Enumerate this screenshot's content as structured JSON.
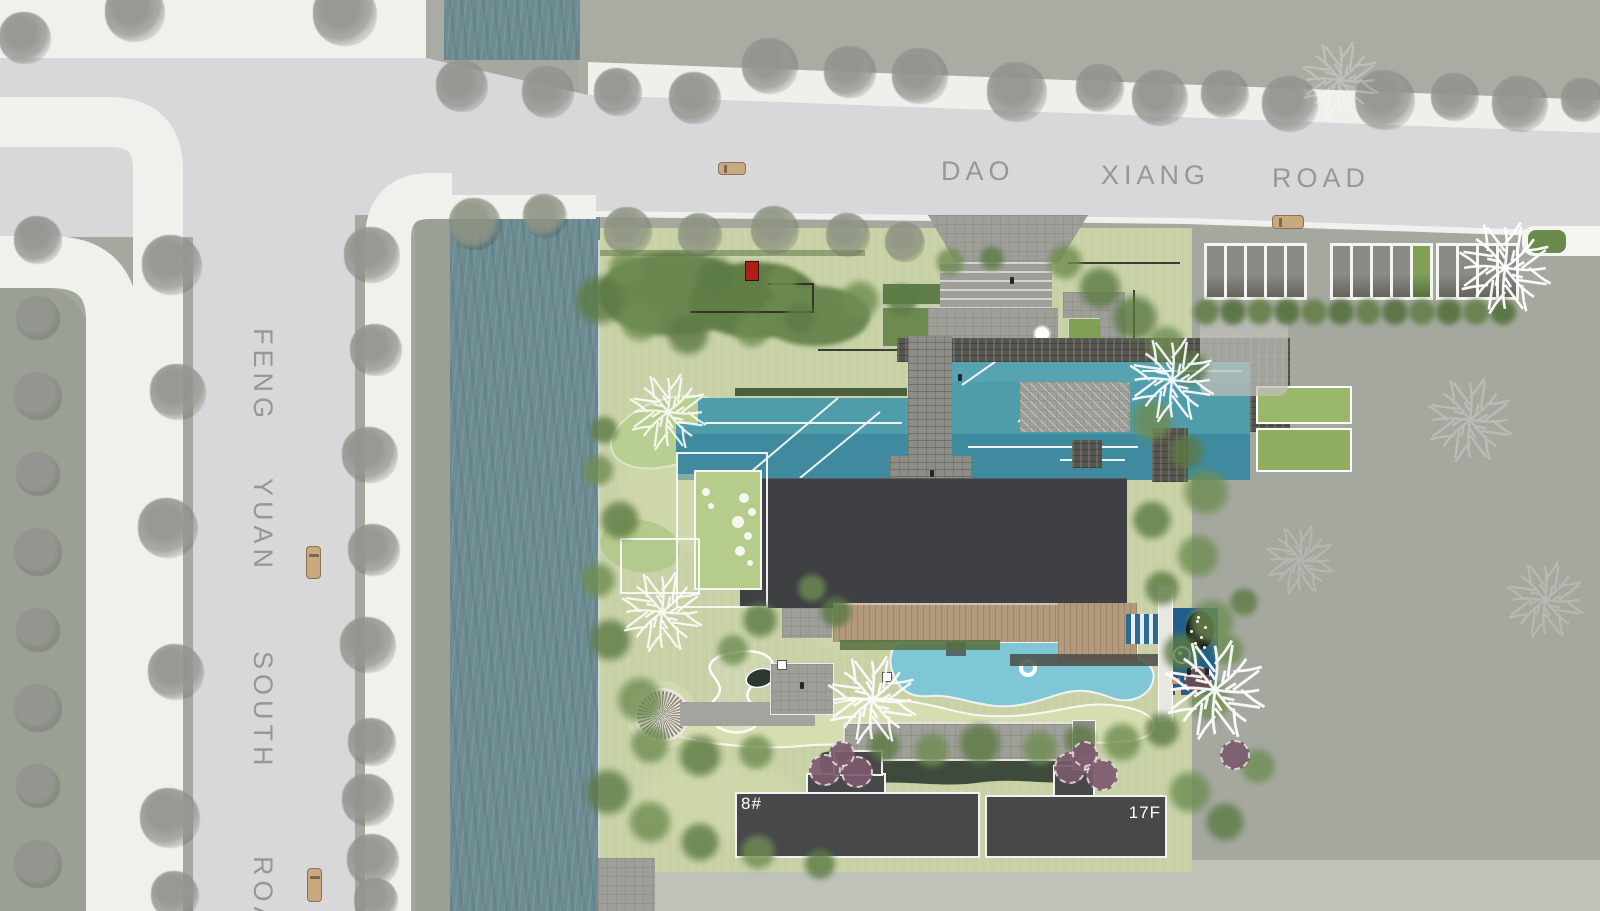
{
  "site_plan": {
    "roads": {
      "top": {
        "name": "DAO XIANG ROAD",
        "words": [
          "DAO",
          "XIANG",
          "ROAD"
        ]
      },
      "left": {
        "name": "FENG YUAN SOUTH ROAD",
        "words": [
          "FENG",
          "YUAN",
          "SOUTH",
          "ROAD"
        ]
      }
    },
    "buildings": [
      {
        "label": "8#"
      },
      {
        "label": "17F"
      }
    ],
    "parking": {
      "stall_groups": [
        5,
        5,
        4
      ],
      "total_stalls": 14
    },
    "vehicles": {
      "cars_on_road": 4
    },
    "landscape_features": [
      "entry-plaza",
      "cascade-wall",
      "reflecting-pool",
      "stone-bridge",
      "clubhouse-roof",
      "timber-deck",
      "swimming-pool",
      "kids-pool",
      "sand-berm",
      "stream",
      "stone-circle-plaza",
      "river-canal",
      "street-parking",
      "hedge-planters"
    ],
    "colors": {
      "road": "#d8d8da",
      "sidewalk": "#f0f0ed",
      "parcel": "#a5a89f",
      "parcel_dark": "#9aa094",
      "river": "#6d8c91",
      "lawn": "#c7d1a5",
      "shrub": "#64814b",
      "reflecting_pool": "#4f9cab",
      "swimming_pool": "#7fc6d7",
      "kids_pool": "#1f5e88",
      "roof": "#3e4044",
      "building": "#47484a",
      "deck": "#b49a7c",
      "stone": "#9f9f9a",
      "stone_dark": "#55544e",
      "accent_red": "#b01f16",
      "tree_gray": "#949490",
      "tree_purple": "#7c5a6d",
      "tree_maroon": "#6b4a52",
      "car": "#c9aa80"
    },
    "decor": {
      "street_trees": [
        [
          25,
          38,
          26
        ],
        [
          135,
          12,
          30
        ],
        [
          345,
          14,
          32
        ],
        [
          462,
          86,
          26
        ],
        [
          548,
          92,
          26
        ],
        [
          618,
          92,
          24
        ],
        [
          695,
          98,
          26
        ],
        [
          770,
          66,
          28
        ],
        [
          850,
          72,
          26
        ],
        [
          920,
          76,
          28
        ],
        [
          1017,
          92,
          30
        ],
        [
          1100,
          88,
          24
        ],
        [
          1160,
          98,
          28
        ],
        [
          1225,
          94,
          24
        ],
        [
          1290,
          104,
          28
        ],
        [
          1385,
          100,
          30
        ],
        [
          1455,
          97,
          24
        ],
        [
          1520,
          104,
          28
        ],
        [
          1583,
          100,
          22
        ],
        [
          38,
          240,
          24
        ],
        [
          38,
          318,
          22
        ],
        [
          38,
          396,
          24
        ],
        [
          38,
          474,
          22
        ],
        [
          38,
          552,
          24
        ],
        [
          38,
          630,
          22
        ],
        [
          38,
          708,
          24
        ],
        [
          38,
          786,
          22
        ],
        [
          38,
          864,
          24
        ],
        [
          172,
          265,
          30
        ],
        [
          178,
          392,
          28
        ],
        [
          168,
          528,
          30
        ],
        [
          176,
          672,
          28
        ],
        [
          170,
          818,
          30
        ],
        [
          175,
          895,
          24
        ],
        [
          372,
          255,
          28
        ],
        [
          376,
          350,
          26
        ],
        [
          370,
          455,
          28
        ],
        [
          374,
          550,
          26
        ],
        [
          368,
          645,
          28
        ],
        [
          372,
          742,
          24
        ],
        [
          368,
          800,
          26
        ],
        [
          373,
          860,
          26
        ],
        [
          376,
          900,
          22
        ]
      ],
      "curb_trees": [
        [
          475,
          224,
          26
        ],
        [
          545,
          216,
          22
        ],
        [
          628,
          231,
          24
        ],
        [
          700,
          235,
          22
        ],
        [
          775,
          230,
          24
        ],
        [
          848,
          235,
          22
        ],
        [
          905,
          242,
          20
        ]
      ],
      "site_trees": [
        [
          600,
          300,
          28,
          0
        ],
        [
          640,
          322,
          22,
          1
        ],
        [
          688,
          334,
          24,
          0
        ],
        [
          752,
          330,
          20,
          1
        ],
        [
          800,
          318,
          18,
          0
        ],
        [
          860,
          300,
          22,
          1
        ],
        [
          902,
          300,
          18,
          0
        ],
        [
          626,
          268,
          20,
          1
        ],
        [
          716,
          276,
          22,
          0
        ],
        [
          782,
          282,
          18,
          1
        ],
        [
          1065,
          262,
          20,
          1
        ],
        [
          1100,
          288,
          24,
          0
        ],
        [
          1135,
          318,
          26,
          0
        ],
        [
          1166,
          345,
          22,
          1
        ],
        [
          1190,
          368,
          20,
          0
        ],
        [
          1152,
          420,
          24,
          1
        ],
        [
          1186,
          452,
          20,
          0
        ],
        [
          1206,
          492,
          26,
          1
        ],
        [
          1152,
          520,
          22,
          0
        ],
        [
          1198,
          556,
          24,
          1
        ],
        [
          1162,
          588,
          20,
          0
        ],
        [
          1212,
          622,
          26,
          1
        ],
        [
          1182,
          652,
          22,
          0
        ],
        [
          1210,
          700,
          24,
          1
        ],
        [
          1162,
          730,
          20,
          0
        ],
        [
          1122,
          742,
          22,
          1
        ],
        [
          1080,
          740,
          18,
          0
        ],
        [
          1040,
          748,
          20,
          1
        ],
        [
          980,
          744,
          24,
          0
        ],
        [
          932,
          750,
          20,
          1
        ],
        [
          884,
          746,
          18,
          0
        ],
        [
          640,
          700,
          26,
          1
        ],
        [
          610,
          640,
          24,
          0
        ],
        [
          598,
          580,
          20,
          1
        ],
        [
          620,
          520,
          22,
          0
        ],
        [
          598,
          470,
          18,
          1
        ],
        [
          604,
          430,
          16,
          0
        ],
        [
          650,
          744,
          22,
          1
        ],
        [
          700,
          756,
          24,
          0
        ],
        [
          756,
          752,
          20,
          1
        ],
        [
          608,
          792,
          26,
          0
        ],
        [
          650,
          822,
          24,
          1
        ],
        [
          700,
          842,
          22,
          0
        ],
        [
          758,
          852,
          20,
          1
        ],
        [
          820,
          864,
          18,
          0
        ],
        [
          1190,
          792,
          24,
          1
        ],
        [
          1225,
          822,
          22,
          0
        ],
        [
          1258,
          766,
          20,
          1
        ],
        [
          836,
          612,
          18,
          0
        ],
        [
          812,
          588,
          16,
          1
        ],
        [
          760,
          620,
          20,
          0
        ],
        [
          733,
          650,
          18,
          1
        ],
        [
          950,
          262,
          16,
          1
        ],
        [
          992,
          258,
          14,
          0
        ],
        [
          1228,
          650,
          18,
          1
        ],
        [
          1244,
          602,
          16,
          0
        ]
      ],
      "line_trees": [
        [
          668,
          412,
          40,
          0.85
        ],
        [
          662,
          612,
          42,
          0.85
        ],
        [
          872,
          700,
          46,
          0.9
        ],
        [
          1172,
          380,
          44,
          0.9
        ],
        [
          1215,
          690,
          52,
          0.92
        ],
        [
          1505,
          268,
          48,
          0.95
        ],
        [
          1340,
          80,
          40,
          0.25
        ],
        [
          1470,
          420,
          44,
          0.22
        ],
        [
          1545,
          600,
          40,
          0.2
        ],
        [
          1300,
          560,
          36,
          0.18
        ]
      ],
      "purple_trees": [
        [
          823,
          768,
          14,
          0
        ],
        [
          855,
          770,
          14,
          0
        ],
        [
          840,
          752,
          11,
          0
        ],
        [
          1068,
          766,
          14,
          0
        ],
        [
          1100,
          773,
          14,
          0
        ],
        [
          1083,
          752,
          11,
          0
        ],
        [
          1196,
          678,
          12,
          1
        ],
        [
          1233,
          753,
          13,
          0
        ]
      ],
      "flowers": [
        [
          744,
          498,
          5
        ],
        [
          752,
          512,
          4
        ],
        [
          738,
          522,
          6
        ],
        [
          748,
          536,
          4
        ],
        [
          740,
          551,
          5
        ],
        [
          750,
          563,
          3
        ],
        [
          706,
          492,
          4
        ],
        [
          711,
          506,
          3
        ]
      ],
      "figures": [
        [
          958,
          374
        ],
        [
          930,
          470
        ],
        [
          800,
          682
        ],
        [
          1010,
          277
        ],
        [
          1187,
          668
        ],
        [
          1205,
          668
        ]
      ],
      "pool_ripples": [
        [
          705,
          423,
          902,
          423
        ],
        [
          968,
          447,
          1138,
          447
        ],
        [
          745,
          477,
          838,
          398
        ],
        [
          800,
          478,
          880,
          412
        ],
        [
          962,
          385,
          1002,
          357
        ],
        [
          1018,
          422,
          1058,
          392
        ],
        [
          1142,
          371,
          1242,
          371
        ],
        [
          1060,
          460,
          1125,
          460
        ]
      ],
      "cars": [
        [
          718,
          162,
          28,
          13
        ],
        [
          1272,
          215,
          32,
          14
        ],
        [
          306,
          546,
          15,
          33
        ],
        [
          307,
          868,
          15,
          34
        ]
      ],
      "parking_groups": [
        [
          1204,
          243,
          5,
          -1
        ],
        [
          1330,
          243,
          5,
          4
        ],
        [
          1436,
          243,
          4,
          -1
        ]
      ],
      "hedge_row": {
        "x": 1206,
        "y": 312,
        "count": 12,
        "step": 27,
        "r": 15
      },
      "oval_dots": [
        [
          1196,
          620
        ],
        [
          1204,
          626
        ],
        [
          1190,
          630
        ],
        [
          1200,
          636
        ],
        [
          1194,
          642
        ],
        [
          1203,
          646
        ],
        [
          1197,
          616
        ]
      ]
    }
  }
}
